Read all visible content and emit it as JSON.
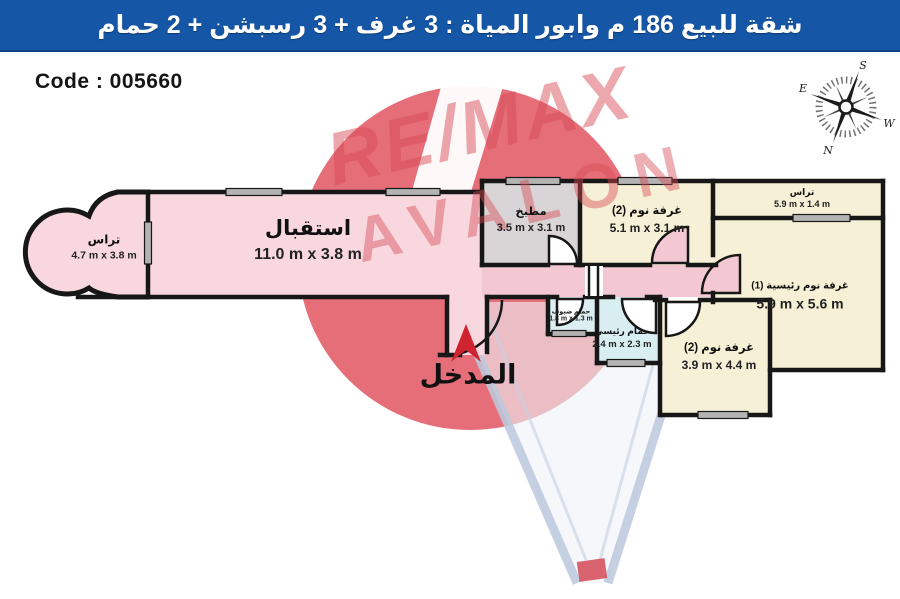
{
  "title_bar": {
    "text": "شقة للبيع 186 م وابور المياة : 3 غرف + 3 رسبشن + 2 حمام",
    "bg_color": "#1557a6",
    "text_color": "#ffffff"
  },
  "code_label": "Code : 005660",
  "compass": {
    "s": "S",
    "e": "E",
    "w": "W",
    "n": "N"
  },
  "watermark": {
    "brand": "RE/MAX",
    "sub": "AVALON",
    "color": "#d84a56"
  },
  "entrance": {
    "label": "المدخل",
    "arrow_color": "#cf2330"
  },
  "plan": {
    "wall_color": "#171717",
    "window_color": "#b3b3b3"
  },
  "rooms": [
    {
      "id": "terrace-left",
      "name": "تراس",
      "dims": "4.7 m x 3.8 m",
      "color": "#f8d8de"
    },
    {
      "id": "reception",
      "name": "استقبال",
      "dims": "11.0 m x 3.8 m",
      "color": "#f8d8de"
    },
    {
      "id": "kitchen",
      "name": "مطبخ",
      "dims": "3.5 m x 3.1 m",
      "color": "#d9d4d5"
    },
    {
      "id": "bedroom-2",
      "name": "غرفة نوم (2)",
      "dims": "5.1 m x 3.1 m",
      "color": "#f6f0d6"
    },
    {
      "id": "terrace-top-right",
      "name": "تراس",
      "dims": "5.9 m x 1.4 m",
      "color": "#f6f0d6"
    },
    {
      "id": "master-bedroom",
      "name": "غرفة نوم رئيسية (1)",
      "dims": "5.9 m x 5.6 m",
      "color": "#f6f0d6"
    },
    {
      "id": "guest-bathroom",
      "name": "حمام ضيوف",
      "dims": "1.8 m x 1.3 m",
      "color": "#dceef2"
    },
    {
      "id": "master-bathroom",
      "name": "حمام رئيسي",
      "dims": "2.4 m x 2.3 m",
      "color": "#d9eef1"
    },
    {
      "id": "bedroom-3",
      "name": "غرفة نوم (2)",
      "dims": "3.9 m x 4.4 m",
      "color": "#f6f0d6"
    },
    {
      "id": "hallway",
      "name": "",
      "dims": "",
      "color": "#f3c8d3"
    }
  ]
}
